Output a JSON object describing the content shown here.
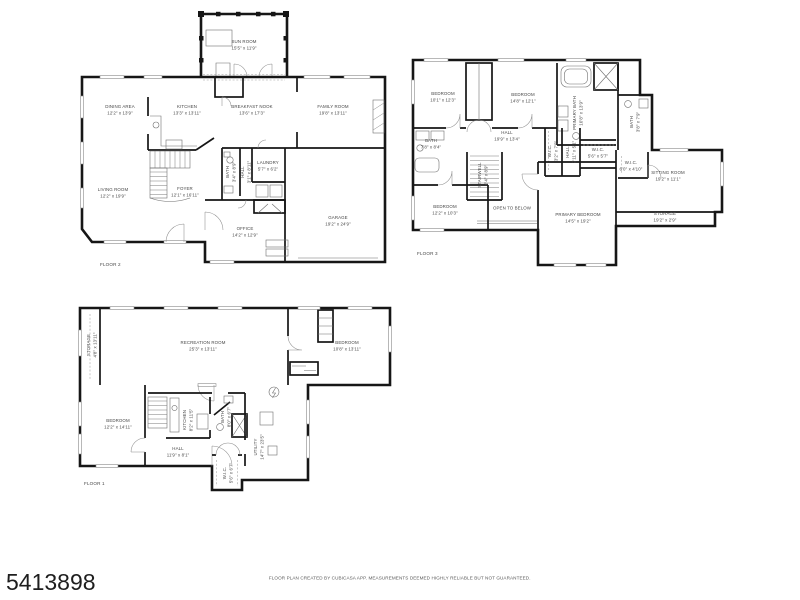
{
  "page": {
    "listing_id": "5413898",
    "disclaimer": "FLOOR PLAN CREATED BY CUBICASA APP. MEASUREMENTS DEEMED HIGHLY RELIABLE BUT NOT GUARANTEED."
  },
  "colors": {
    "wall": "#161616",
    "label": "#474747",
    "fixture": "#6f6f6f",
    "background": "#ffffff"
  },
  "floors": [
    {
      "label": "FLOOR 2",
      "rooms": [
        {
          "name": "SUN ROOM",
          "dims": "15'5\" x 11'9\""
        },
        {
          "name": "DINING AREA",
          "dims": "12'2\" x 13'9\""
        },
        {
          "name": "KITCHEN",
          "dims": "13'3\" x 13'11\""
        },
        {
          "name": "BREAKFAST NOOK",
          "dims": "13'6\" x 17'3\""
        },
        {
          "name": "FAMILY ROOM",
          "dims": "19'8\" x 13'11\""
        },
        {
          "name": "LIVING ROOM",
          "dims": "12'2\" x 19'9\""
        },
        {
          "name": "FOYER",
          "dims": "12'1\" x 16'11\""
        },
        {
          "name": "BATH",
          "dims": "3'4\" x 8'9\""
        },
        {
          "name": "HALL",
          "dims": "3'1\" x 8'11\""
        },
        {
          "name": "LAUNDRY",
          "dims": "5'7\" x 6'2\""
        },
        {
          "name": "OFFICE",
          "dims": "14'2\" x 12'9\""
        },
        {
          "name": "GARAGE",
          "dims": "19'2\" x 24'9\""
        }
      ]
    },
    {
      "label": "FLOOR 3",
      "rooms": [
        {
          "name": "BEDROOM",
          "dims": "10'1\" x 12'3\""
        },
        {
          "name": "BEDROOM",
          "dims": "14'8\" x 12'1\""
        },
        {
          "name": "PRIMARY BATH",
          "dims": "10'8\" x 13'9\""
        },
        {
          "name": "BATH",
          "dims": "3'8\" x 7'9\""
        },
        {
          "name": "HALL",
          "dims": "19'9\" x 13'4\""
        },
        {
          "name": "BATH",
          "dims": "7'8\" x 8'4\""
        },
        {
          "name": "STAIRWELL",
          "dims": "6'4\" x 8'9\""
        },
        {
          "name": "W.I.C.",
          "dims": "3'2\" x 7'9\""
        },
        {
          "name": "HALL",
          "dims": "2'11\" x 5'1\""
        },
        {
          "name": "W.I.C.",
          "dims": "5'6\" x 5'7\""
        },
        {
          "name": "W.I.C.",
          "dims": "6'0\" x 4'10\""
        },
        {
          "name": "SITTING ROOM",
          "dims": "19'2\" x 11'1\""
        },
        {
          "name": "STORAGE",
          "dims": "19'2\" x 2'9\""
        },
        {
          "name": "BEDROOM",
          "dims": "12'2\" x 10'3\""
        },
        {
          "name": "OPEN TO BELOW",
          "dims": ""
        },
        {
          "name": "PRIMARY BEDROOM",
          "dims": "14'5\" x 19'2\""
        }
      ]
    },
    {
      "label": "FLOOR 1",
      "rooms": [
        {
          "name": "STORAGE",
          "dims": "4'8\" x 13'11\""
        },
        {
          "name": "RECREATION ROOM",
          "dims": "25'3\" x 13'11\""
        },
        {
          "name": "BEDROOM",
          "dims": "10'8\" x 13'11\""
        },
        {
          "name": "BEDROOM",
          "dims": "12'2\" x 14'11\""
        },
        {
          "name": "KITCHEN",
          "dims": "8'2\" x 11'5\""
        },
        {
          "name": "BATH",
          "dims": "8'0\" x 6'7\""
        },
        {
          "name": "HALL",
          "dims": "11'9\" x 8'1\""
        },
        {
          "name": "UTILITY",
          "dims": "14'7\" x 23'5\""
        },
        {
          "name": "W.I.C.",
          "dims": "5'6\" x 6'7\""
        }
      ]
    }
  ]
}
